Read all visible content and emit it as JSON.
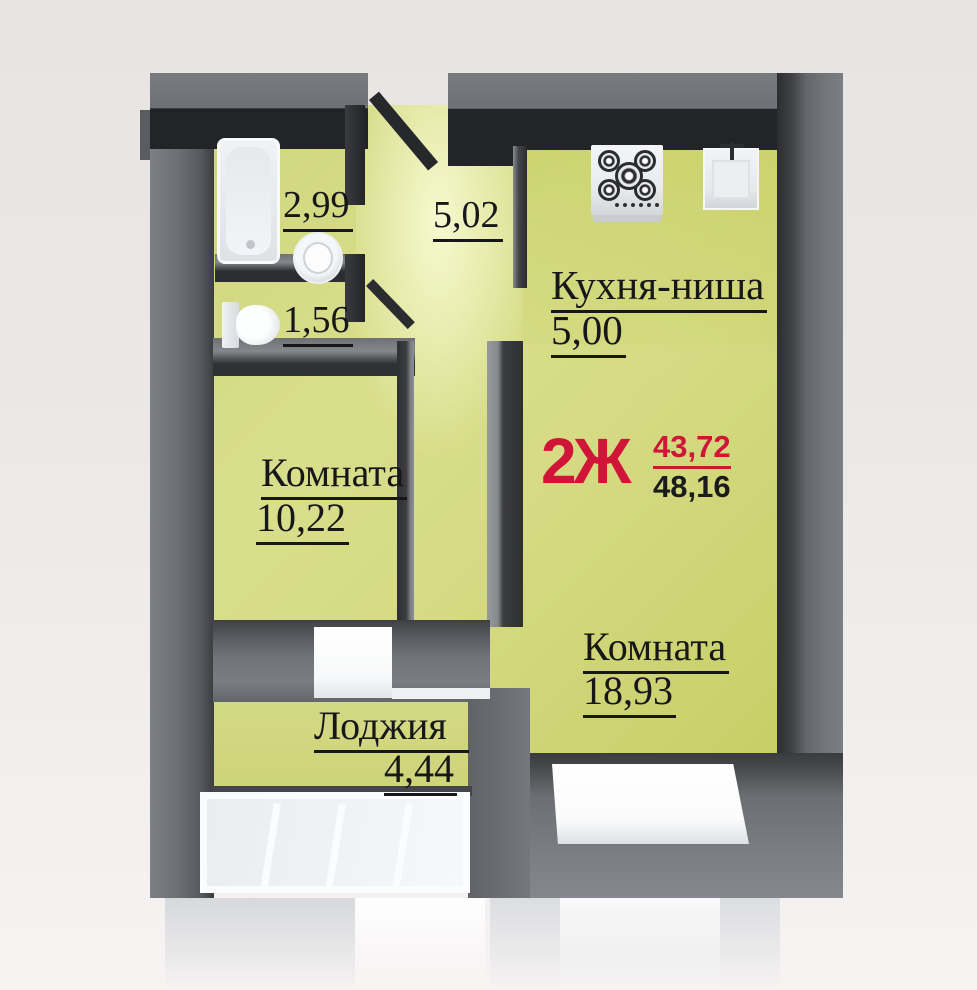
{
  "unit": {
    "label": "2Ж",
    "living_area": "43,72",
    "total_area": "48,16"
  },
  "rooms": {
    "kitchen": {
      "name": "Кухня-ниша",
      "area": "5,00"
    },
    "room_small": {
      "name": "Комната",
      "area": "10,22"
    },
    "room_large": {
      "name": "Комната",
      "area": "18,93"
    },
    "loggia": {
      "name": "Лоджия",
      "area": "4,44"
    },
    "bathroom": {
      "area": "2,99"
    },
    "wc": {
      "area": "1,56"
    },
    "hall": {
      "area": "5,02"
    }
  },
  "colors": {
    "accent_red": "#d01538",
    "floor_green": "#d5da82",
    "wall_gray": "#6e7175",
    "wall_dark": "#2a2b2e",
    "label_black": "#17171a",
    "fixture_white": "#f2f3f5"
  },
  "fixtures": {
    "bathtub": "bathtub",
    "washbasin": "washbasin",
    "toilet": "toilet",
    "stove": "stove",
    "kitchen_sink": "kitchen-sink",
    "loggia_glazing": "loggia-glazing",
    "room_window": "window",
    "balcony_window": "balcony-window"
  }
}
